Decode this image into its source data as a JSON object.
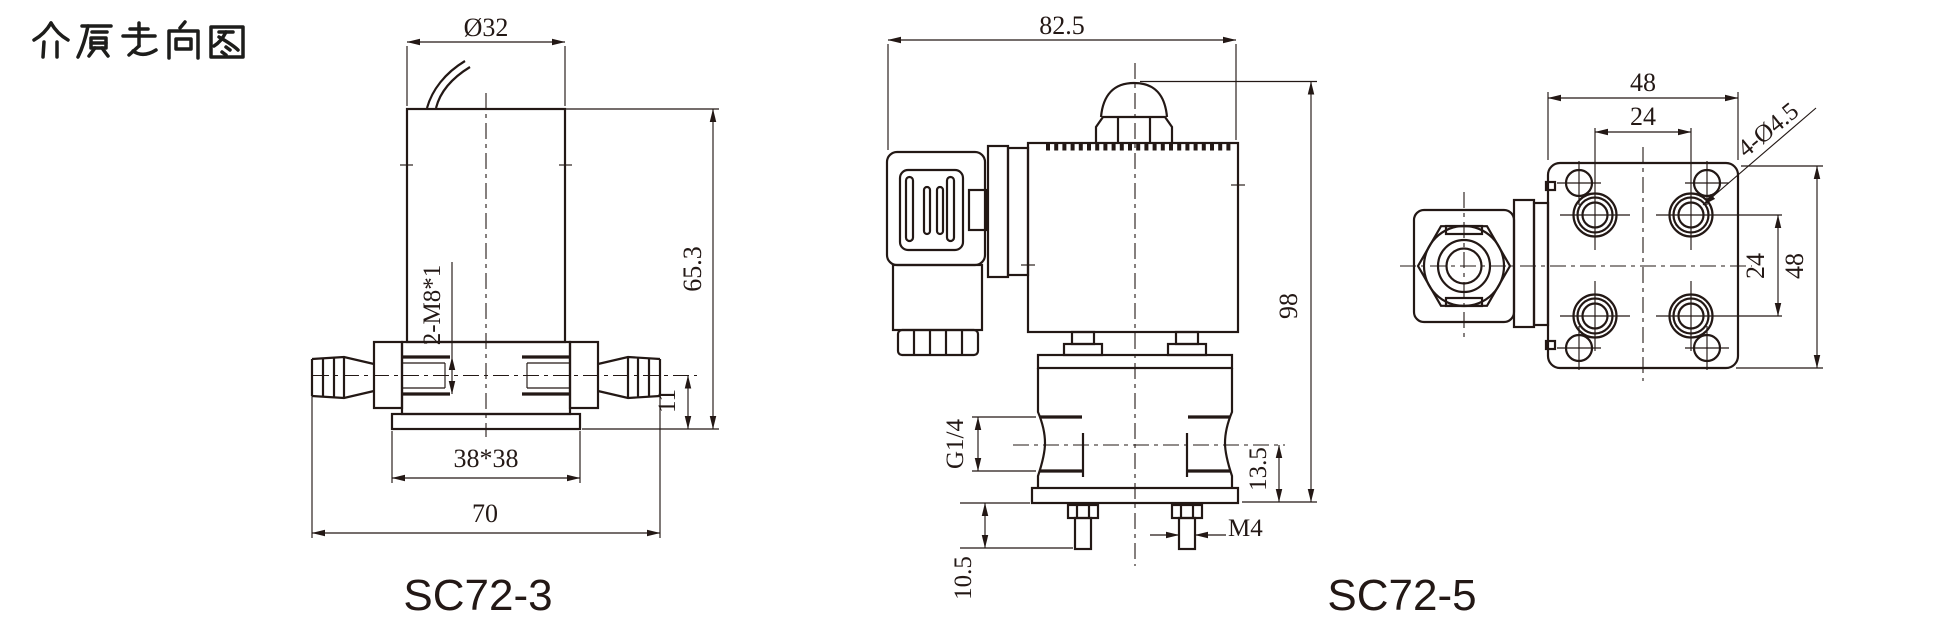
{
  "page": {
    "title": "介质走向图"
  },
  "palette": {
    "ink": "#231815",
    "background": "#ffffff"
  },
  "sc72_3": {
    "label": "SC72-3",
    "dims": {
      "coil_diameter": "Ø32",
      "overall_height": "65.3",
      "port_thread": "2-M8*1",
      "port_center_height": "11",
      "base_square": "38*38",
      "overall_width": "70"
    }
  },
  "sc72_5": {
    "label": "SC72-5",
    "front_view": {
      "overall_width": "82.5",
      "overall_height": "98",
      "port_thread": "G1/4",
      "port_center_to_base": "13.5",
      "stud_thread": "M4",
      "stud_length": "10.5"
    },
    "top_view": {
      "mount_plate_width": "48",
      "port_spacing_horizontal": "24",
      "mount_holes": "4-Ø4.5",
      "port_spacing_vertical": "24",
      "mount_plate_height": "48"
    }
  }
}
